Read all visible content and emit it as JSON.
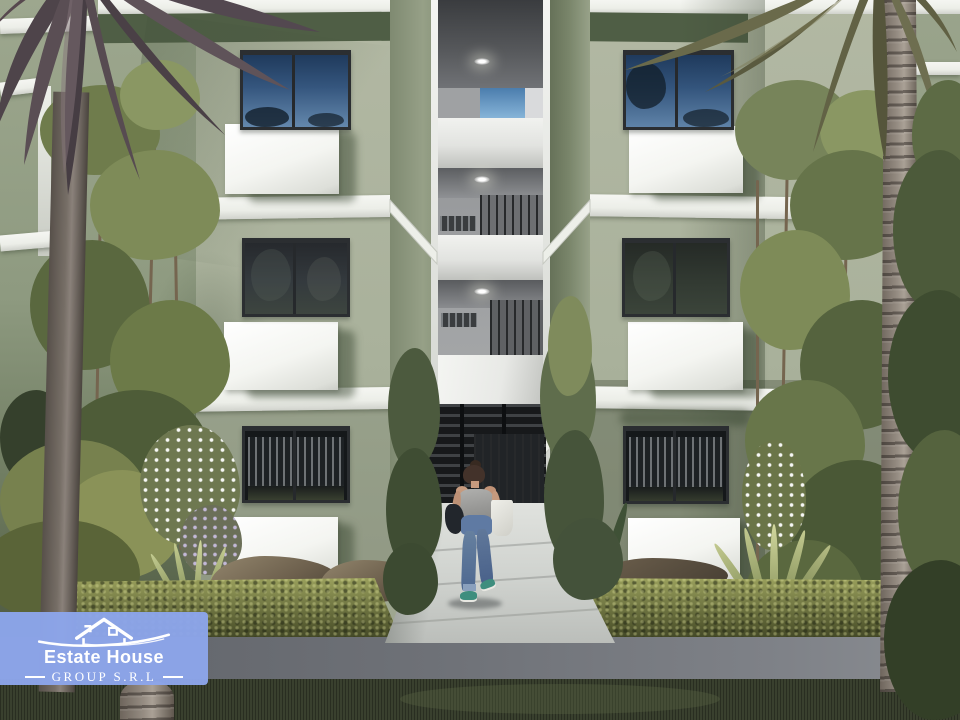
{
  "watermark": {
    "brand": "Estate House",
    "subtitle": "GROUP S.R.L",
    "badge_color": "#8ca5ea",
    "text_color": "#ffffff",
    "icon": "house-roof-swoosh-logo"
  },
  "scene": {
    "type": "architectural_exterior_render",
    "subject": "Three-story sage-green apartment building with a central open stairwell corridor, landscaped entrance walkway, palms and hedges",
    "floors_visible": 3,
    "stairwell": {
      "downlights": 3,
      "sky_opening": true,
      "white_parapets": 3,
      "railings": "dark metal balusters"
    },
    "windows": {
      "count_visible": 6,
      "style": "dark-framed sliding windows",
      "upper_reflection": "blue sky with foliage",
      "middle_reflection": "dark trees",
      "ground_interior": "vertical blinds"
    },
    "entrance": {
      "gate": "dark horizontal-slat metal gate",
      "walkway": "light concrete path between hedges"
    },
    "person": {
      "description": "woman walking toward the entrance, seen from behind",
      "top": "gray tank top",
      "bottom": "blue jeans",
      "shoes": "teal sneakers",
      "bags": [
        "dark shoulder bag",
        "white tote bag"
      ]
    },
    "landscape": [
      "left palm tree",
      "right palm tree",
      "slender trees",
      "boxwood hedge",
      "white flowering shrubs",
      "agave plants",
      "rocks",
      "dark lawn",
      "concrete curb strip"
    ],
    "palette": {
      "wall": "#a9b19b",
      "wall_shadow": "#55624a",
      "slab_white": "#f2f3ee",
      "window_glass_sky": "#33517a",
      "gate_dark": "#1a1c1e",
      "walkway": "#ced0cc",
      "hedge": "#6b7140",
      "grass": "#39402e",
      "curb": "#6e7177",
      "palm_trunk": "#a79d92",
      "sky_patch": "#6ea0c8"
    }
  }
}
